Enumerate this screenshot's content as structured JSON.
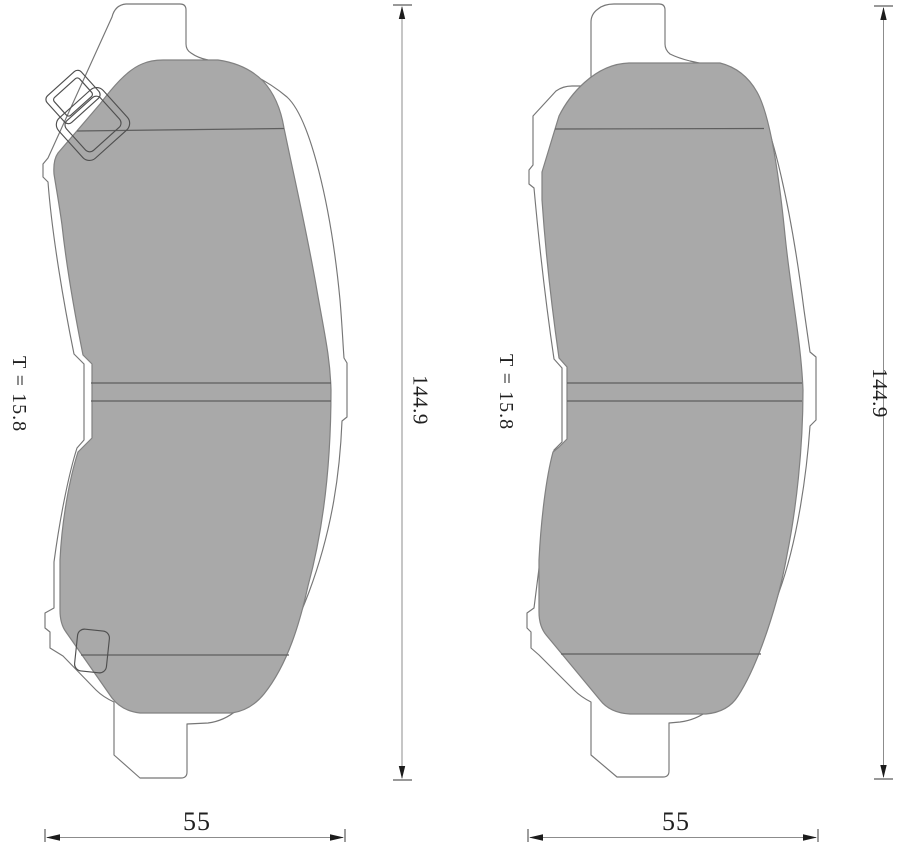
{
  "drawing": {
    "description": "brake pad technical drawing, two side views with dimensions",
    "left_view": {
      "thickness_label": "T = 15.8",
      "height_value": "144.9",
      "width_value": "55"
    },
    "right_view": {
      "thickness_label": "T = 15.8",
      "height_value": "144.9",
      "width_value": "55"
    },
    "colors": {
      "background": "#ffffff",
      "friction_material": "#a9a9a9",
      "backplate_outline": "#767676",
      "feature_line": "#5e5e5e",
      "dimension_line": "#8c8c8c",
      "arrow": "#1c1c1c",
      "text": "#1f1f1f"
    }
  }
}
